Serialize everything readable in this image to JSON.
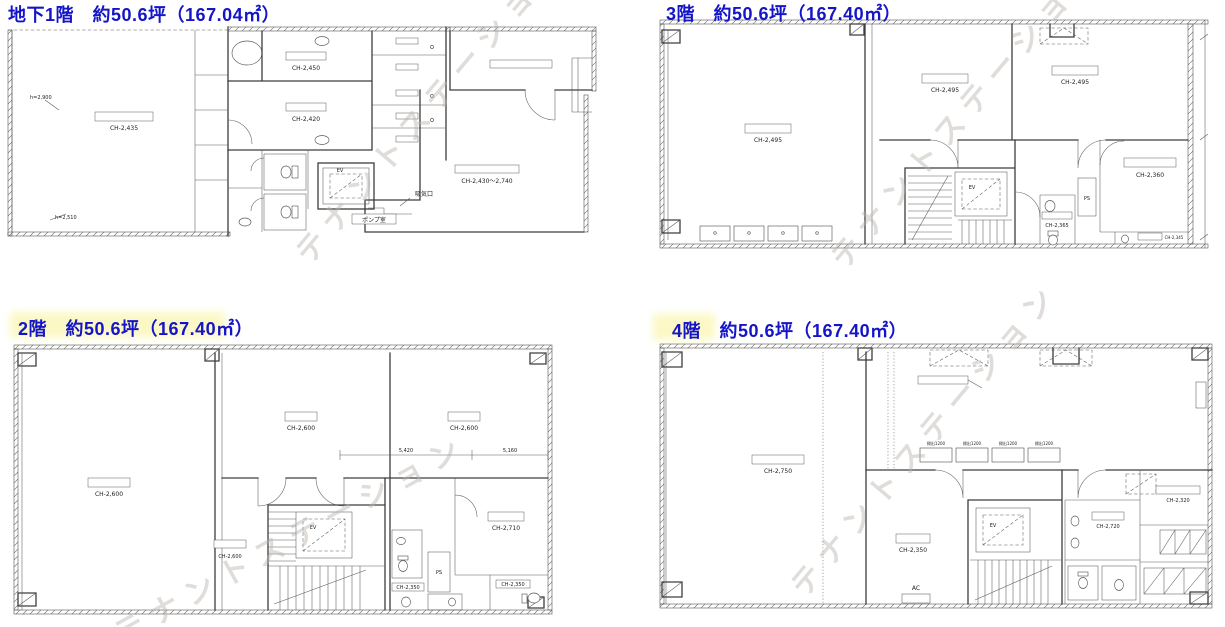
{
  "watermark": {
    "text": "テナントステーション",
    "color": "#b9b3ad"
  },
  "colors": {
    "title_blue": "#1414c8",
    "line_gray": "#3d3d3d"
  },
  "floors": [
    {
      "id": "b1f",
      "title": "地下1階　約50.6坪（167.04㎡）",
      "labels": [
        "CH-2,435",
        "CH-2,450",
        "CH-2,420",
        "EV",
        "ポンプ室",
        "吸気口",
        "CH-2,430〜2,740",
        "h=2,900",
        "h=2,510"
      ]
    },
    {
      "id": "3f",
      "title": "3階　約50.6坪（167.40㎡）",
      "labels": [
        "CH-2,495",
        "CH-2,495",
        "CH-2,495",
        "EV",
        "CH-2,360",
        "CH-2,345",
        "PS",
        "CH-2,365"
      ]
    },
    {
      "id": "2f",
      "title": "2階　約50.6坪（167.40㎡）",
      "labels": [
        "CH-2,600",
        "CH-2,600",
        "CH-2,600",
        "EV",
        "CH-2,710",
        "CH-2,350",
        "PS",
        "5,420",
        "5,160",
        "CH-2,350",
        "CH-2,600"
      ]
    },
    {
      "id": "4f",
      "title": "4階　約50.6坪（167.40㎡）",
      "labels": [
        "CH-2,750",
        "EV",
        "CH-2,350",
        "CH-2,320",
        "掃出1200",
        "AC",
        "CH-2,720"
      ]
    }
  ]
}
